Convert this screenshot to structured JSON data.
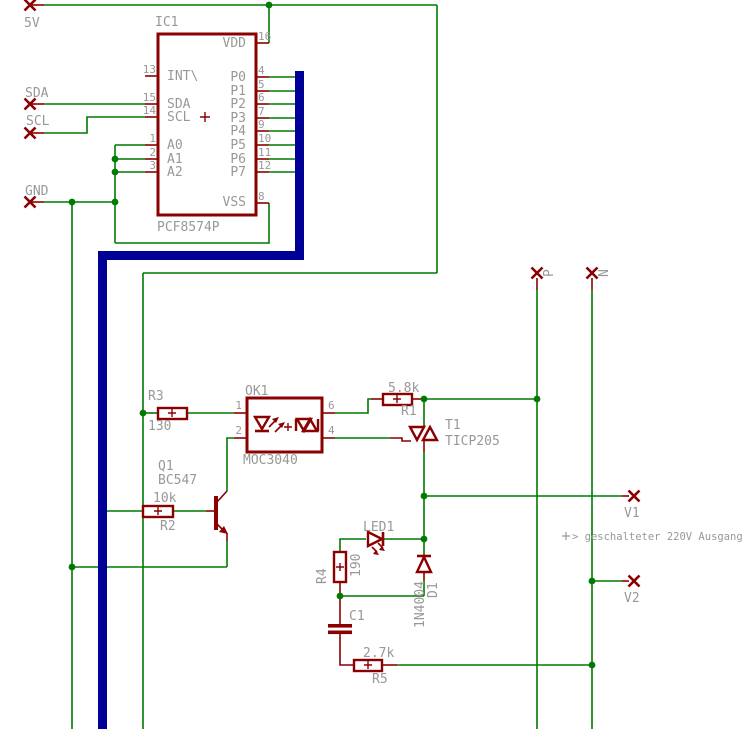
{
  "colors": {
    "wire_green": "#007A00",
    "component_red": "#8B0000",
    "bus_blue": "#000096",
    "text_grey": "#989898",
    "background": "#FFFFFF"
  },
  "net_labels": {
    "v5": "5V",
    "sda": "SDA",
    "scl": "SCL",
    "gnd": "GND",
    "p": "P",
    "n": "N",
    "v1": "V1",
    "v2": "V2"
  },
  "annotation": {
    "output_note": "> geschalteter 220V Ausgang"
  },
  "ic1": {
    "name": "IC1",
    "value": "PCF8574P",
    "left_pins": [
      {
        "number": "13",
        "name": "INT\\"
      },
      {
        "number": "15",
        "name": "SDA"
      },
      {
        "number": "14",
        "name": "SCL"
      },
      {
        "number": "1",
        "name": "A0"
      },
      {
        "number": "2",
        "name": "A1"
      },
      {
        "number": "3",
        "name": "A2"
      }
    ],
    "right_pins": [
      {
        "number": "16",
        "name": "VDD"
      },
      {
        "number": "4",
        "name": "P0"
      },
      {
        "number": "5",
        "name": "P1"
      },
      {
        "number": "6",
        "name": "P2"
      },
      {
        "number": "7",
        "name": "P3"
      },
      {
        "number": "9",
        "name": "P4"
      },
      {
        "number": "10",
        "name": "P5"
      },
      {
        "number": "11",
        "name": "P6"
      },
      {
        "number": "12",
        "name": "P7"
      },
      {
        "number": "8",
        "name": "VSS"
      }
    ]
  },
  "components": {
    "r1": {
      "name": "R1",
      "value": "5.8k"
    },
    "r2": {
      "name": "R2",
      "value": "10k"
    },
    "r3": {
      "name": "R3",
      "value": "130"
    },
    "r4": {
      "name": "R4",
      "value": "190"
    },
    "r5": {
      "name": "R5",
      "value": "2.7k"
    },
    "q1": {
      "name": "Q1",
      "value": "BC547"
    },
    "ok1": {
      "name": "OK1",
      "value": "MOC3040",
      "pin_numbers": [
        "1",
        "2",
        "6",
        "4"
      ]
    },
    "t1": {
      "name": "T1",
      "value": "TICP205"
    },
    "led1": {
      "name": "LED1"
    },
    "d1": {
      "name": "D1",
      "value": "1N4004"
    },
    "c1": {
      "name": "C1"
    }
  }
}
